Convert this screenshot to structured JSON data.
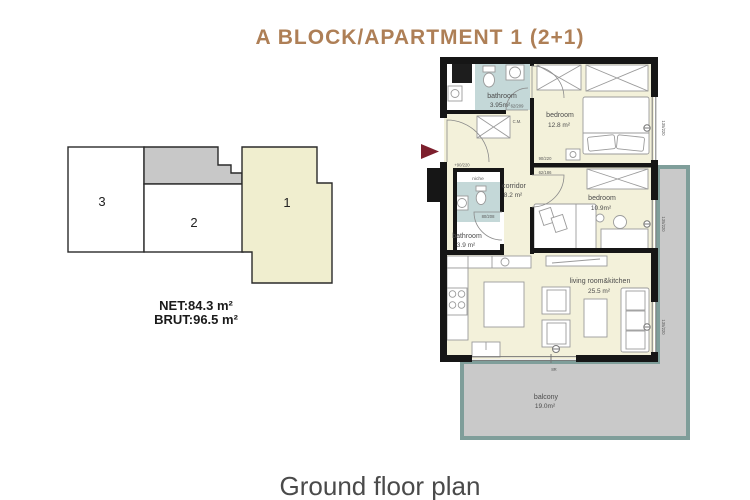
{
  "header": {
    "title": "A BLOCK/APARTMENT 1 (2+1)"
  },
  "key_plan": {
    "unit_1": "1",
    "unit_2": "2",
    "unit_3": "3"
  },
  "area_summary": {
    "net": "NET:84.3 m²",
    "brut": "BRUT:96.5 m²"
  },
  "plan": {
    "rooms": {
      "bathroom_top": {
        "name": "bathroom",
        "area": "3.95m²"
      },
      "bedroom_1": {
        "name": "bedroom",
        "area": "12.8 m²"
      },
      "niche": {
        "name": "niche"
      },
      "corridor": {
        "name": "corridor",
        "area": "8.2 m²"
      },
      "bedroom_2": {
        "name": "bedroom",
        "area": "10.9m²"
      },
      "bathroom_small": {
        "name": "bathroom",
        "area": "3.9 m²"
      },
      "living_kitchen": {
        "name": "living room&kitchen",
        "area": "25.5 m²"
      },
      "balcony": {
        "name": "balcony",
        "area": "19.0m²"
      }
    },
    "annotations": {
      "entrance_door": "+90/220",
      "bathroom_top_door": "62/209",
      "bedroom_1_door": "90/220",
      "bedroom_2_door": "62/186",
      "bathroom_small_door": "80/208",
      "wardrobe": "C.M.",
      "balcony_door": "8R",
      "window": "135/220"
    }
  },
  "footer": {
    "caption": "Ground floor plan"
  },
  "colors": {
    "accent": "#ae7f56",
    "room_fill": "#f3f1da",
    "wet_room_fill": "#c4d8d8",
    "balcony_fill": "#c9c9c9",
    "balcony_border": "#7f9e9a",
    "wall": "#161616",
    "entry_arrow": "#7d1f2d"
  }
}
